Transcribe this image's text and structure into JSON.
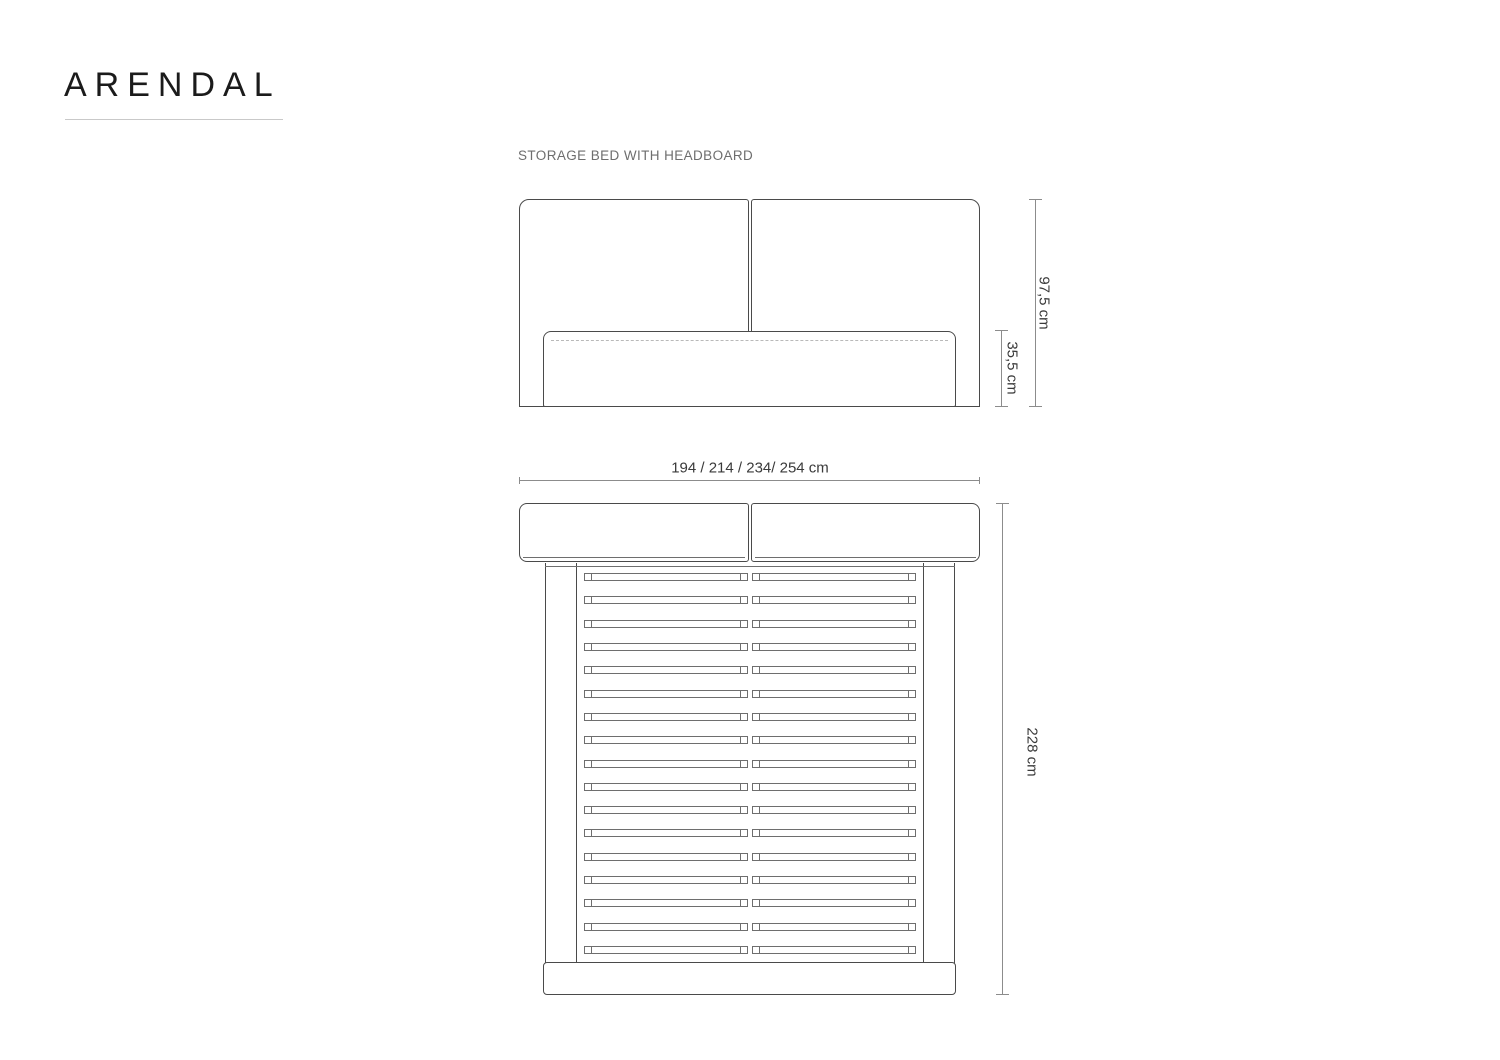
{
  "header": {
    "title": "ARENDAL",
    "subtitle": "STORAGE BED WITH HEADBOARD"
  },
  "diagram": {
    "product": "storage bed with headboard",
    "views": {
      "front": {
        "name": "headboard front elevation"
      },
      "top": {
        "name": "bed frame top view",
        "slat_rows": 17
      }
    },
    "labels": {
      "height_total": "97,5 cm",
      "height_base": "35,5 cm",
      "width_options": "194 / 214 / 234/ 254 cm",
      "length": "228 cm"
    },
    "colors": {
      "line_dark": "#4a4a4a",
      "line_light": "#6e6e6e",
      "line_dashed": "#b9b9b9",
      "dim_line": "#8c8c8c",
      "dim_text": "#3a3a3a",
      "title_text": "#1b1b1b",
      "subtitle_text": "#6e6e6e",
      "underline": "#c9c9c9"
    }
  }
}
